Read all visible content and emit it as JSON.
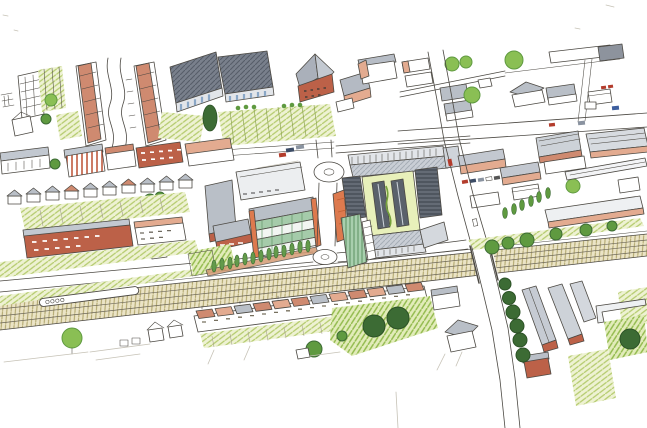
{
  "meta": {
    "medium": "Hand-drawn aerial perspective sketch of a town-centre masterplan, ink line with coloured pencil on white paper",
    "visible_text": "none"
  },
  "palette": {
    "paper": "#ffffff",
    "ink": "#4c4943",
    "pencil": "#c6c2b6",
    "terracotta": "#cf8a70",
    "salmon": "#e3ab90",
    "brick": "#bc6148",
    "roofGray": "#b9bfc7",
    "roofGrayDark": "#8d939d",
    "fascia": "#e2e5e9",
    "shedGray": "#79808c",
    "shedGrayLine": "#565d69",
    "glassBlue": "#8aa7c6",
    "grassBg": "#eef2d3",
    "grassLine": "#b4cb6d",
    "grassBrightBg": "#e2ecba",
    "grassBrightLine": "#92ba4d",
    "treeBright": "#8abf54",
    "treeMid": "#5f9a40",
    "treeDark": "#3c6b34",
    "oliveBg": "#ebe4c6",
    "oliveLine": "#b1a66d",
    "louverBg": "#646b75",
    "louverLine": "#3e444d",
    "greenLouvBg": "#a8cfae",
    "greenLouvLine": "#639668",
    "greenGlass": "#a5cbaa",
    "orange": "#dd7a4e",
    "pathBrown": "#d49b74",
    "court": "#e8f0ba",
    "glazedBar": "#5a616b",
    "carRed": "#b33c2c",
    "carBlue": "#3d5e9e",
    "carGray": "#8a93a0",
    "carDark": "#3c4c66"
  },
  "scene": {
    "regions": [
      {
        "id": "northwest-terraces",
        "desc": "outlined terrace rows with garden strips and round trees"
      },
      {
        "id": "salmon-terrace-rows",
        "desc": "two diagonal rows of salmon-roofed terraces beside an S-curved street"
      },
      {
        "id": "retail-sheds",
        "desc": "two large dark grey box buildings with glazed bases"
      },
      {
        "id": "church-block",
        "desc": "brick tower with tall pyramidal slate roof and neighbouring hip-roof houses"
      },
      {
        "id": "allotments",
        "desc": "striped green allotment gardens with hedge bushes and a tall dark tree"
      },
      {
        "id": "west-streets",
        "desc": "rows of terraced and semi-detached houses with back gardens and verge road"
      },
      {
        "id": "new-development-west",
        "desc": "L-shaped brick block and glazed office with orange piers, lawn and young tree avenue"
      },
      {
        "id": "local-road",
        "desc": "estate road with north and south roundabouts"
      },
      {
        "id": "green-roof-complex",
        "desc": "large store with planted green roof strips, louvred wings, orange corner and green louvre facade"
      },
      {
        "id": "east-industrial-estate",
        "desc": "pink-walled industrial sheds, yards, parked cars and a young tree avenue"
      },
      {
        "id": "northeast-neighbourhood",
        "desc": "detached houses, street trees and parked cars around a crossroads"
      },
      {
        "id": "main-road",
        "desc": "main road running south across the railway bridge"
      },
      {
        "id": "railway",
        "desc": "railway corridor with a train, ballast hatching and lineside trees"
      },
      {
        "id": "south-terraces",
        "desc": "long terrace row with front gardens and mature dark trees"
      },
      {
        "id": "southeast-neighbourhood",
        "desc": "terrace blocks, street trees, lawns and garden walls beside the road"
      },
      {
        "id": "sketch-marks",
        "desc": "unfinished faint pencil guide lines at the sketch edges"
      }
    ]
  }
}
